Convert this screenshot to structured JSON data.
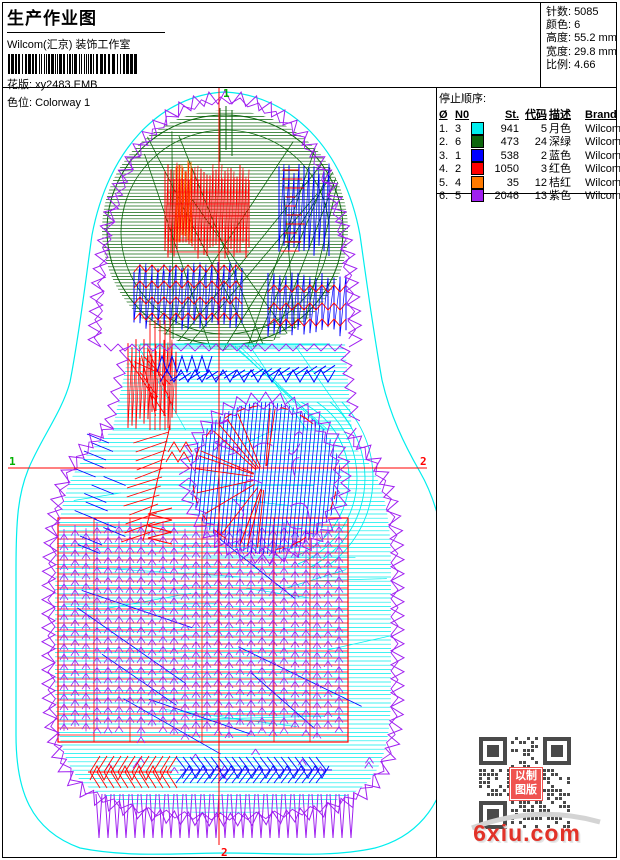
{
  "header": {
    "title": "生产作业图",
    "studio": "Wilcom(汇京) 装饰工作室",
    "design_label": "花版:",
    "design_value": "xy2483.EMB",
    "colorway_label": "色位:",
    "colorway_value": "Colorway 1"
  },
  "stats": {
    "items": [
      {
        "label": "针数:",
        "value": "5085"
      },
      {
        "label": "颜色:",
        "value": "6"
      },
      {
        "label": "高度:",
        "value": "55.2 mm"
      },
      {
        "label": "宽度:",
        "value": "29.8 mm"
      },
      {
        "label": "比例:",
        "value": "4.66"
      }
    ]
  },
  "stop_sequence": {
    "title": "停止顺序:",
    "columns": [
      "Ø",
      "N0",
      "",
      "St.",
      "代码",
      "描述",
      "Brand",
      "元素"
    ],
    "rows": [
      {
        "seq": "1.",
        "needle": "3",
        "color": "#00EEEE",
        "st": "941",
        "code": "5",
        "desc": "月色",
        "brand": "Wilcom",
        "elem": ""
      },
      {
        "seq": "2.",
        "needle": "6",
        "color": "#0D660D",
        "st": "473",
        "code": "24",
        "desc": "深绿",
        "brand": "Wilcom",
        "elem": ""
      },
      {
        "seq": "3.",
        "needle": "1",
        "color": "#0000FF",
        "st": "538",
        "code": "2",
        "desc": "蓝色",
        "brand": "Wilcom",
        "elem": ""
      },
      {
        "seq": "4.",
        "needle": "2",
        "color": "#FF0000",
        "st": "1050",
        "code": "3",
        "desc": "红色",
        "brand": "Wilcom",
        "elem": ""
      },
      {
        "seq": "5.",
        "needle": "4",
        "color": "#FF7A00",
        "st": "35",
        "code": "12",
        "desc": "桔红",
        "brand": "Wilcom",
        "elem": ""
      },
      {
        "seq": "6.",
        "needle": "5",
        "color": "#A020F0",
        "st": "2046",
        "code": "13",
        "desc": "紫色",
        "brand": "Wilcom",
        "elem": ""
      }
    ]
  },
  "markers": {
    "start": "1",
    "end": "2"
  },
  "footer": {
    "site": "6xiu.com",
    "stamp_line1": "以制",
    "stamp_line2": "图版"
  }
}
